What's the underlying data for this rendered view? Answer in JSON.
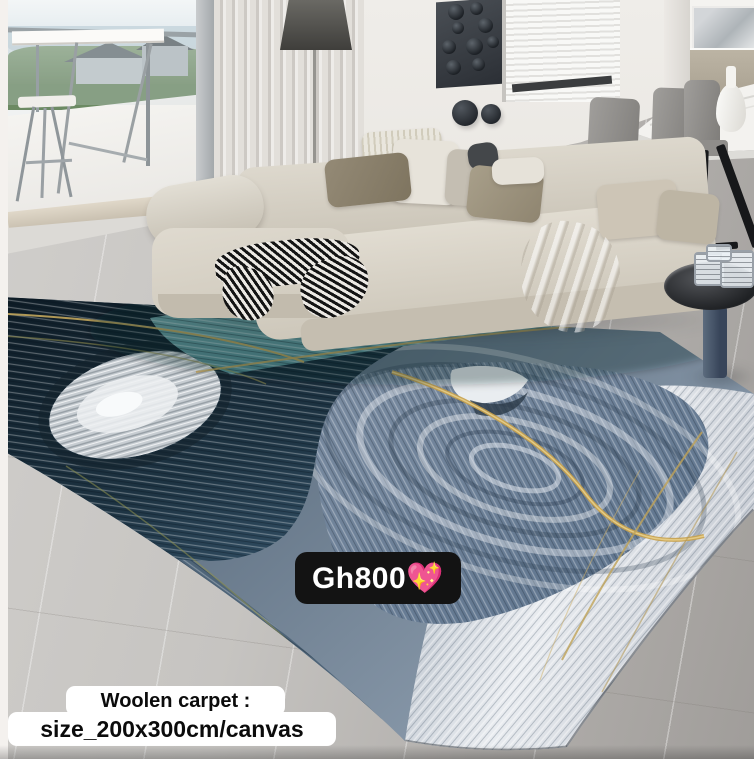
{
  "photo": {
    "subject": "Living room scene showing abstract blue agate woolen carpet with L-shaped beige sofa, dining set and balcony",
    "palette": {
      "rug_navy": "#16242e",
      "rug_slate": "#5d7890",
      "rug_teal": "#6fa6a9",
      "rug_silver": "#e7eaee",
      "rug_gold": "#c8a24e",
      "sofa": "#d6d1c5",
      "floor_tile": "#c3c1be",
      "wall": "#eceae6"
    }
  },
  "overlays": {
    "price_tag": {
      "text": "Gh800💖",
      "bg": "#131313",
      "color": "#ffffff"
    },
    "caption": {
      "line1": "Woolen carpet :",
      "line2": "size_200x300cm/canvas",
      "bg": "#ffffff",
      "color": "#0b0b0b"
    }
  }
}
